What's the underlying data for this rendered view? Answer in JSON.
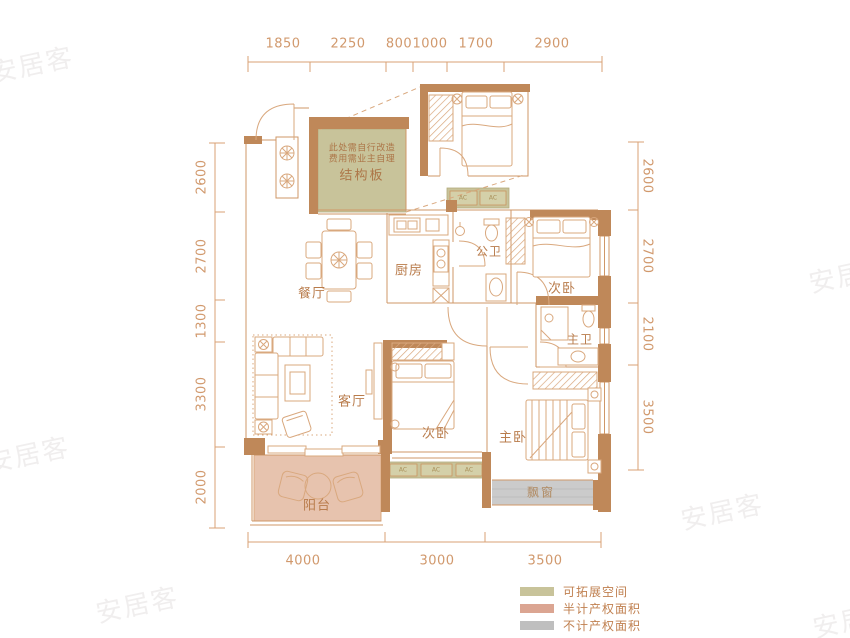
{
  "colors": {
    "wall": "#bf8859",
    "thin_line": "#d9a87e",
    "room_label_text": "#b97c4c",
    "dimension_text": "#d1996d",
    "expandable_green": "#c8c39a",
    "half_area_pink": "#dba592",
    "no_area_gray": "#bfbfbf",
    "bay_window_gray": "#cbcbcb",
    "balcony_pink": "#e7c3ae"
  },
  "dims": {
    "top": [
      "1850",
      "2250",
      "800",
      "1000",
      "1700",
      "2900"
    ],
    "left": [
      "2600",
      "2700",
      "1300",
      "3300",
      "2000"
    ],
    "right": [
      "2600",
      "2700",
      "2100",
      "3500"
    ],
    "bottom": [
      "4000",
      "3000",
      "3500"
    ]
  },
  "rooms": {
    "dining": "餐厅",
    "kitchen": "厨房",
    "public_bath": "公卫",
    "bedroom_top": "次卧",
    "master_bath": "主卫",
    "living": "客厅",
    "bedroom_bottom": "次卧",
    "master_bedroom": "主卧",
    "balcony": "阳台",
    "bay_window": "飘窗"
  },
  "structure": {
    "slab": "结构板",
    "note_line1": "此处需自行改造",
    "note_line2": "费用需业主自理",
    "ac": "AC"
  },
  "legend": [
    {
      "label": "可拓展空间",
      "color": "#c8c39a"
    },
    {
      "label": "半计产权面积",
      "color": "#dba592"
    },
    {
      "label": "不计产权面积",
      "color": "#bfbfbf"
    }
  ],
  "watermark": {
    "text": "安居客"
  }
}
